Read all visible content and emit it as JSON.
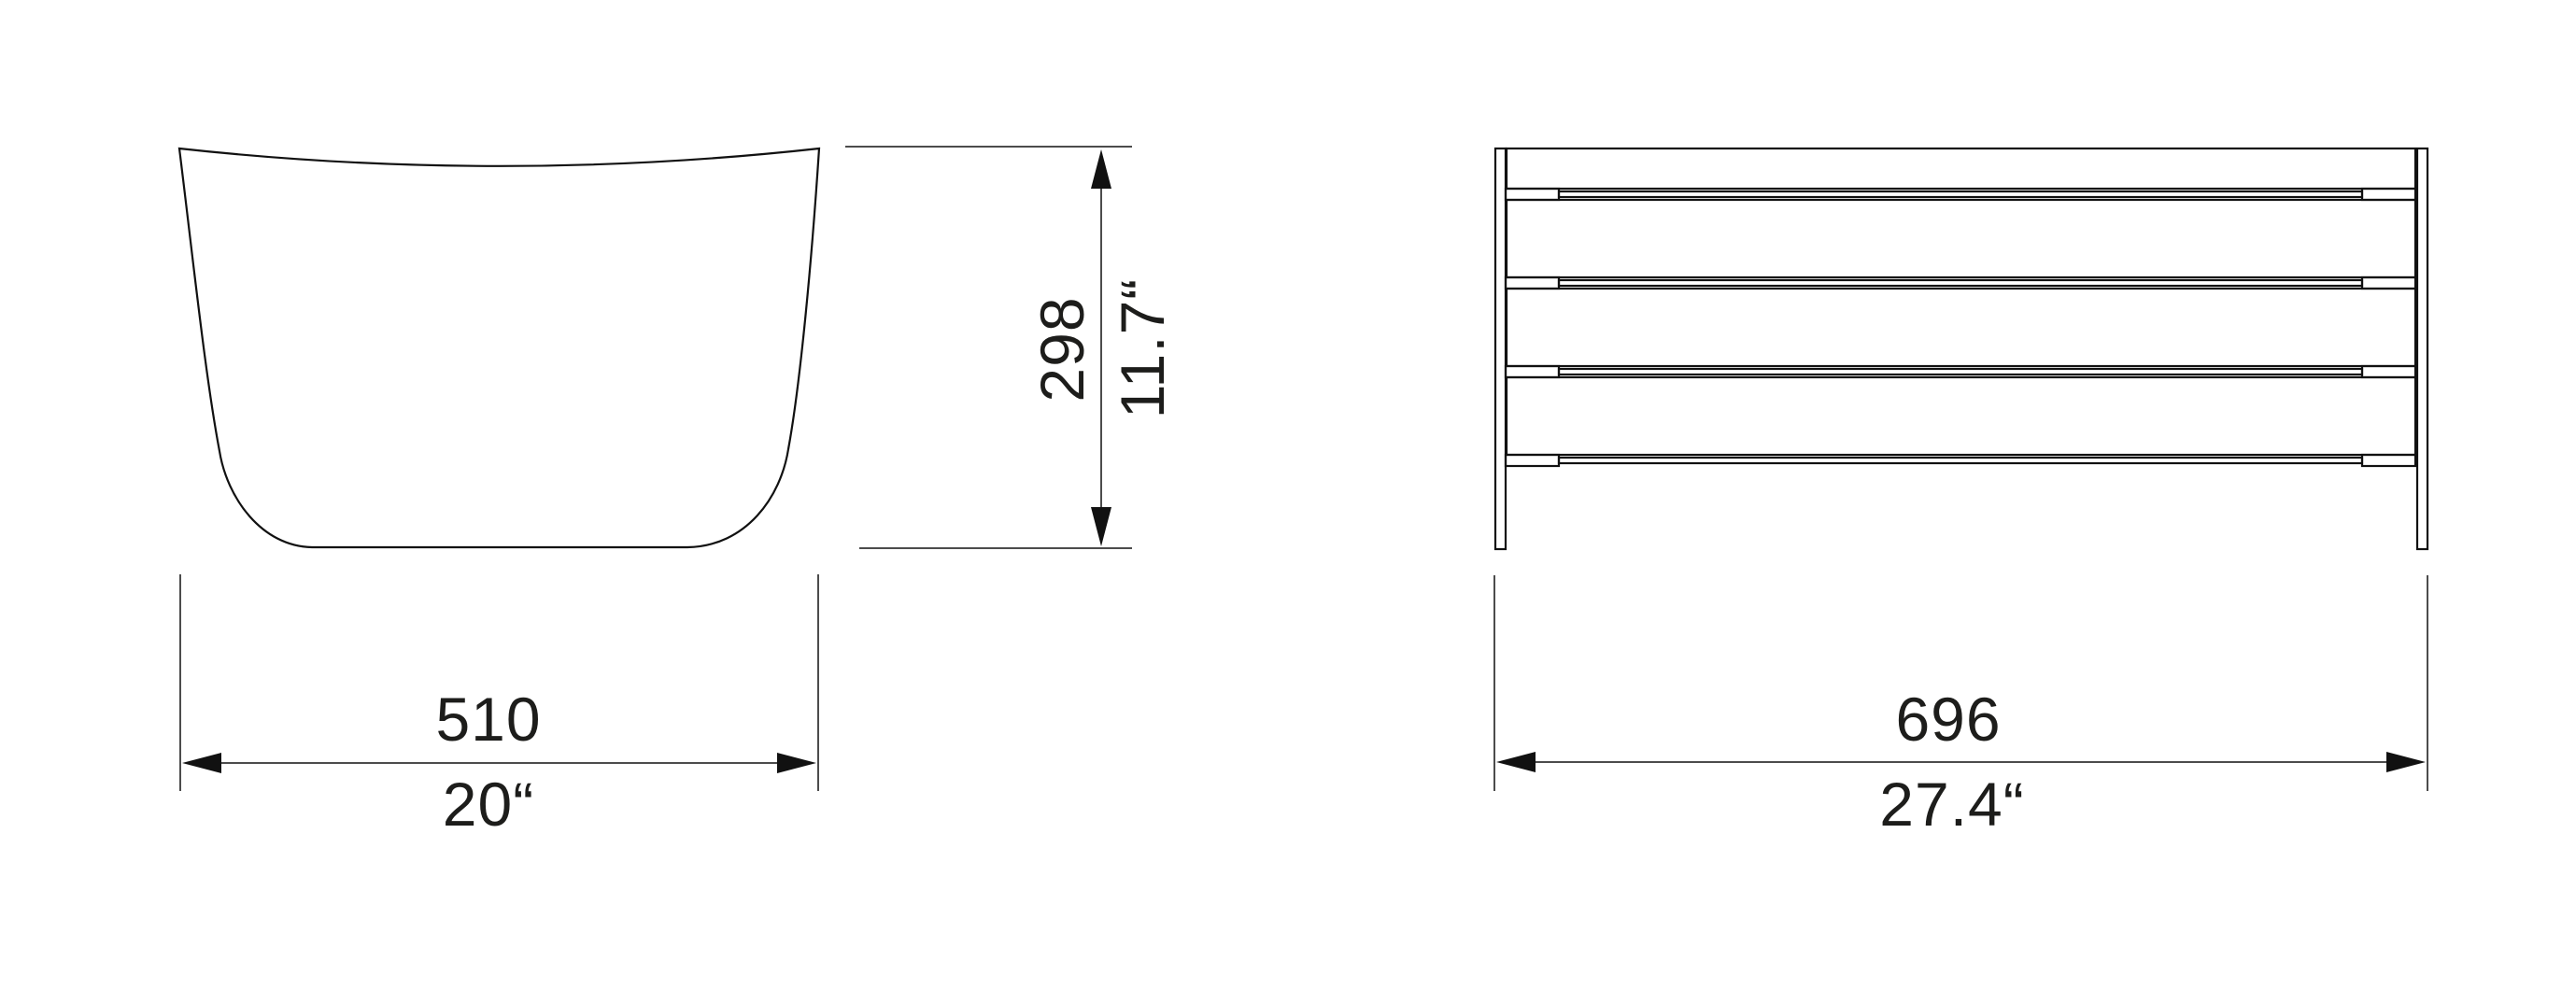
{
  "canvas": {
    "background": "#ffffff",
    "line_color": "#111111",
    "text_color": "#1d1d1b"
  },
  "views": {
    "side": {
      "label": "side-view-of-seat-shell",
      "height_dim": {
        "mm": "298",
        "inches": "11.7“"
      },
      "width_dim": {
        "mm": "510",
        "inches": "20“"
      }
    },
    "front": {
      "label": "front-view-of-slatted-frame",
      "width_dim": {
        "mm": "696",
        "inches": "27.4“"
      }
    }
  }
}
